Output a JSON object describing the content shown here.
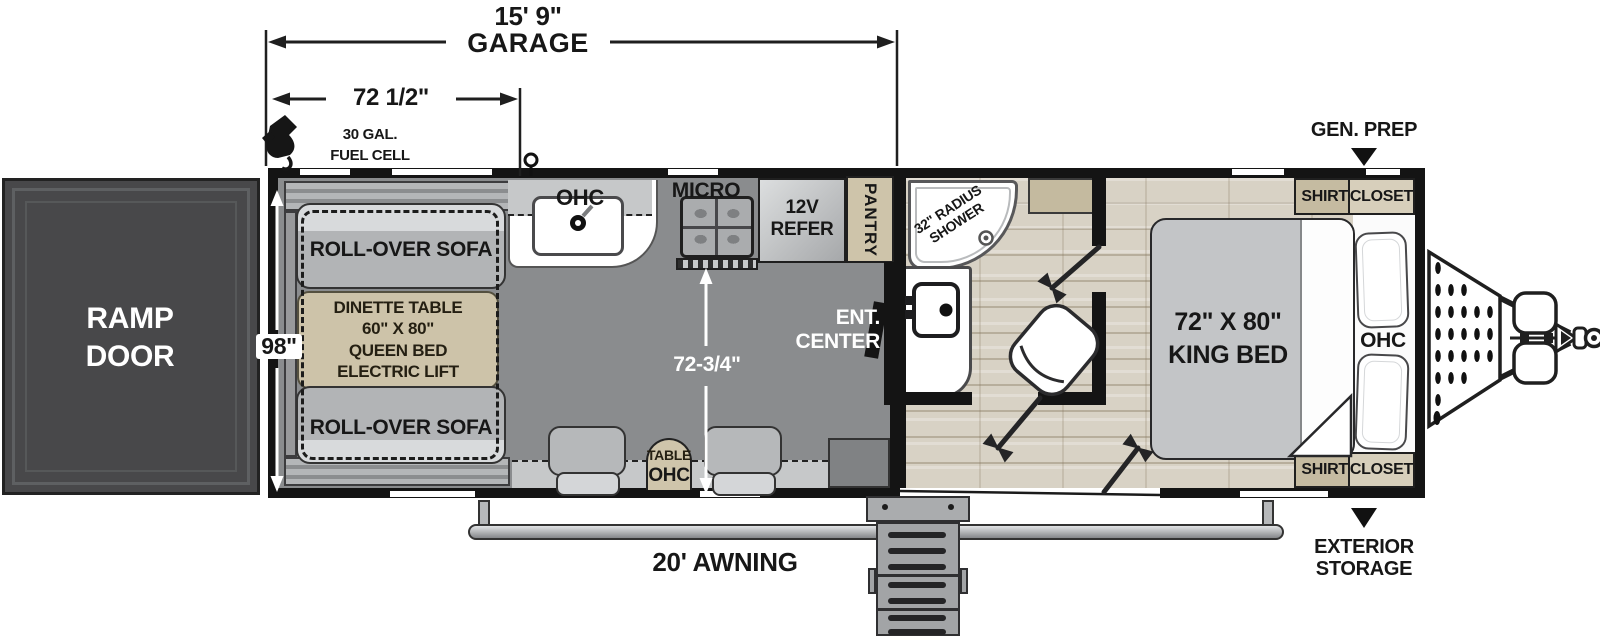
{
  "dims": {
    "garage_len": "15' 9\"",
    "garage_word": "GARAGE",
    "garage_part": "72 1/2\"",
    "body_width": "98\"",
    "garage_interior": "72-3/4\""
  },
  "exterior": {
    "ramp_line1": "RAMP",
    "ramp_line2": "DOOR",
    "fuel_line1": "30 GAL.",
    "fuel_line2": "FUEL CELL",
    "awning": "20' AWNING",
    "gen_prep": "GEN. PREP",
    "storage_line1": "EXTERIOR",
    "storage_line2": "STORAGE"
  },
  "garage": {
    "sofa_top": "ROLL-OVER SOFA",
    "sofa_bottom": "ROLL-OVER SOFA",
    "dinette_lines": [
      "DINETTE TABLE",
      "60\" X 80\"",
      "QUEEN BED",
      "ELECTRIC LIFT"
    ],
    "table": "TABLE",
    "table_ohc": "OHC",
    "ent_line1": "ENT.",
    "ent_line2": "CENTER"
  },
  "kitchen": {
    "ohc": "OHC",
    "micro": "MICRO",
    "refer_line1": "12V",
    "refer_line2": "REFER",
    "pantry": "PANTRY"
  },
  "bathroom": {
    "shower_line1": "32\" RADIUS",
    "shower_line2": "SHOWER"
  },
  "bedroom": {
    "bed_line1": "72\" X 80\"",
    "bed_line2": "KING BED",
    "ohc": "OHC",
    "closet_top_word1": "SHIRT",
    "closet_top_word2": "CLOSET",
    "closet_bottom_word1": "SHIRT",
    "closet_bottom_word2": "CLOSET"
  },
  "colors": {
    "wall": "#141414",
    "garage_floor": "#8a8c8e",
    "wood_floor": "#d8d2c5",
    "tan": "#cdc3a9",
    "sofa_gray": "#b2b4b6"
  }
}
